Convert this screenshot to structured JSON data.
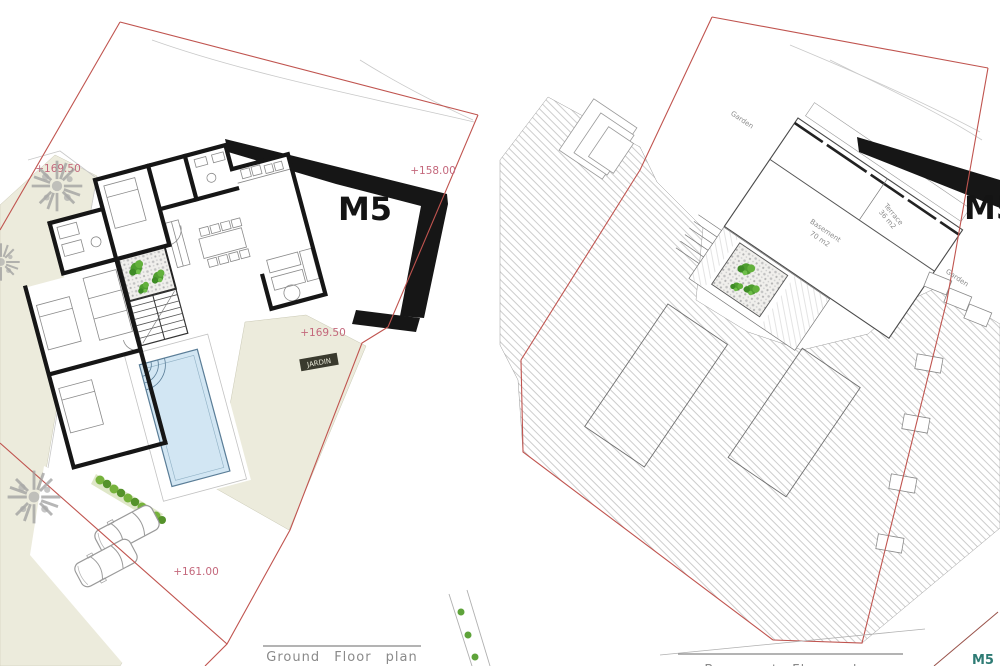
{
  "sheet": {
    "title": "Villa M5 site plans"
  },
  "ground": {
    "caption": "Ground Floor plan",
    "mark": "M5",
    "garden_tag": "JARDIN",
    "levels": {
      "top_left": "+169.50",
      "top_right": "+158.00",
      "garden": "+169.50",
      "driveway": "+161.00"
    }
  },
  "basement": {
    "caption": "Basement Floor plan",
    "mark": "M5",
    "corner_mark": "M5",
    "labels": {
      "garden_top": "Garden",
      "garden_right": "Garden",
      "basement_name": "Basement",
      "basement_area": "70 m2",
      "terrace_name": "Terrace",
      "terrace_area": "36 m2"
    }
  },
  "colors": {
    "boundary_red": "#c0544f",
    "level_pink": "#c4687c",
    "wall_black": "#161616",
    "pool_blue": "#d2e6f3",
    "garden_beige": "#ecebdc",
    "plant_green": "#4e9d2e",
    "hatch_gray": "#b8b8b8",
    "caption_gray": "#8a8a8a",
    "corner_teal": "#2e7b74"
  }
}
